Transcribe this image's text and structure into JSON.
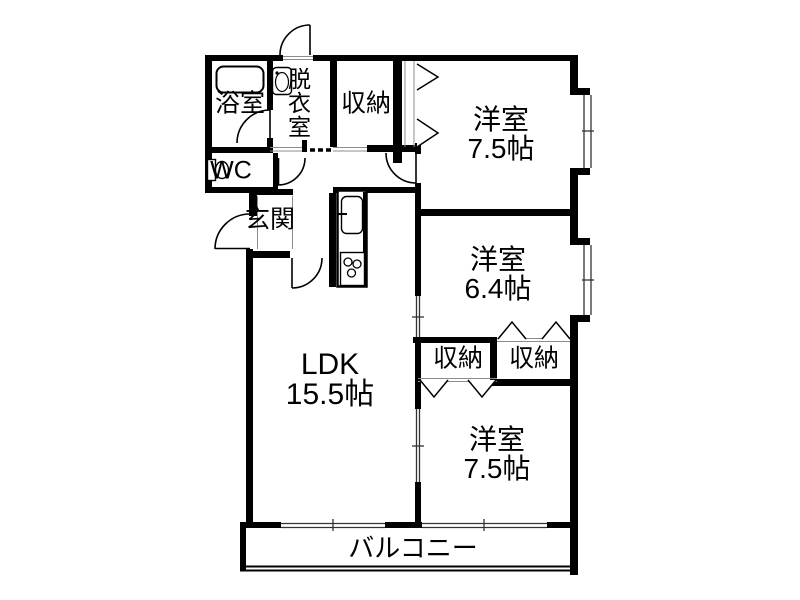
{
  "plan": {
    "background": "#ffffff",
    "wall_color": "#000000",
    "line_color": "#8c8c8c",
    "rooms": [
      {
        "id": "bathroom",
        "name": "浴室"
      },
      {
        "id": "dressing_room",
        "name": "脱衣室"
      },
      {
        "id": "storage_hall",
        "name": "収納"
      },
      {
        "id": "wc",
        "name": "WC"
      },
      {
        "id": "entrance",
        "name": "玄関"
      },
      {
        "id": "western_room_top",
        "name": "洋室",
        "size": "7.5帖"
      },
      {
        "id": "western_room_middle",
        "name": "洋室",
        "size": "6.4帖"
      },
      {
        "id": "storage_left",
        "name": "収納"
      },
      {
        "id": "storage_right",
        "name": "収納"
      },
      {
        "id": "ldk",
        "name": "LDK",
        "size": "15.5帖"
      },
      {
        "id": "western_room_bottom",
        "name": "洋室",
        "size": "7.5帖"
      },
      {
        "id": "balcony",
        "name": "バルコニー"
      }
    ],
    "fixtures": {
      "bathtub": "bathtub-icon",
      "washbasin": "washbasin-icon",
      "toilet": "toilet-icon",
      "kitchen_sink": "kitchen-sink-icon",
      "stove": "stove-burners-icon"
    }
  }
}
